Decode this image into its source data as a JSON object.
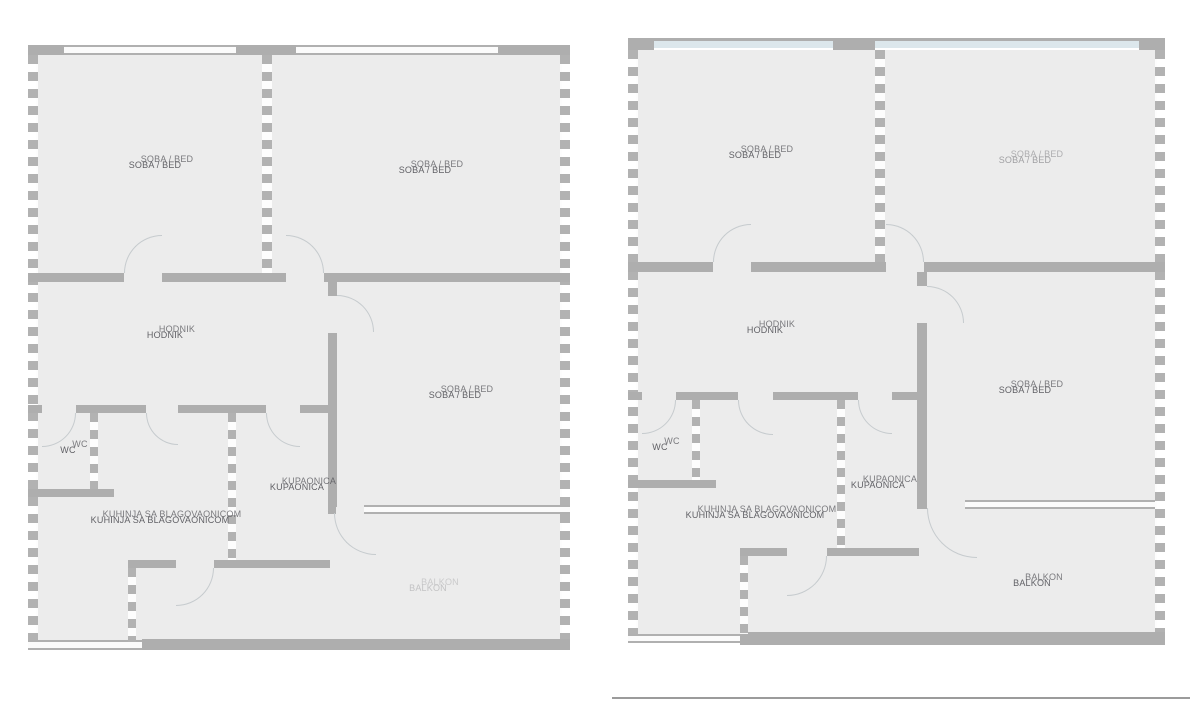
{
  "colors": {
    "background": "#ffffff",
    "floor_fill": "#ececec",
    "wall_gray": "#aeaeae",
    "window_glass_blue": "#dce7ec",
    "label_text": "#48484e",
    "door_arc": "#c6cbce"
  },
  "plans": [
    {
      "id": "left",
      "rooms": {
        "bedroom1": "SOBA / BED",
        "bedroom2": "SOBA / BED",
        "hall": "HODNIK",
        "bedroom3": "SOBA / BED",
        "wc": "WC",
        "bathroom": "KUPAONICA",
        "kitchen": "KUHINJA SA BLAGOVAONICOM",
        "balcony": "BALKON"
      }
    },
    {
      "id": "right",
      "rooms": {
        "bedroom1": "SOBA / BED",
        "bedroom2": "SOBA / BED",
        "hall": "HODNIK",
        "bedroom3": "SOBA / BED",
        "wc": "WC",
        "bathroom": "KUPAONICA",
        "kitchen": "KUHINJA SA BLAGOVAONICOM",
        "balcony": "BALKON"
      }
    }
  ]
}
